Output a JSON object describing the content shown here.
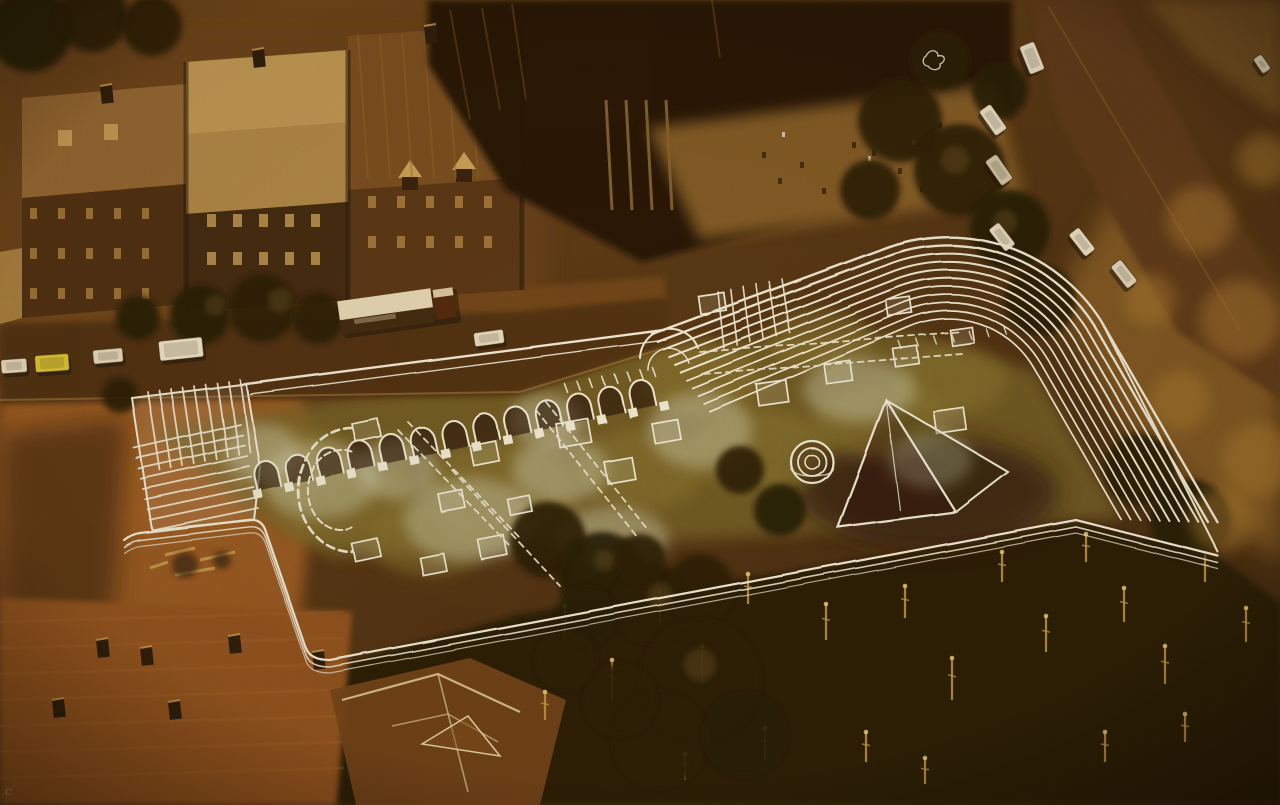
{
  "image": {
    "title": "Aerial photograph with architectural proposal overlay",
    "description": "Vintage amber-toned aerial photograph of a historic cathedral precinct. A white hand-drawn architectural proposal is superimposed on the photo: an L-shaped shelter with an arched arcade, a ribbed roof band sweeping around a large curved corner, a pyramid skylight, a small circular well and dashed outlines of excavated ruins in a garden court. Terraced rowhouses and a parked box lorry line the street at top left, cars park along a tree-lined street at upper right, a rust-orange plaza opens at left, and dark gothic pinnacled roofs fill the bottom of the frame.",
    "style": "1970s halftone colour print, heavy sepia-amber cast, coarse grain",
    "width_px": 1280,
    "height_px": 805
  },
  "palette": {
    "deep_shadow": "#231405",
    "mid_brown": "#5f3b15",
    "golden_tan": "#b9873b",
    "highlight_gold": "#e2c587",
    "plaza_orange": "#965722",
    "street_brown": "#47290e",
    "overlay_ink": "#f1efe0",
    "cool_ink": "#dde6e2",
    "pale_excavation": "#d5dbc6",
    "moss_green": "#7d6e2c",
    "taxi_yellow": "#ddc632",
    "car_white": "#e9dfc6",
    "pinnacle_gold": "#c79a44"
  },
  "scene": {
    "marginal_mark": "c",
    "overlay": {
      "label": "proposed shelter drawing",
      "ink": "#f1efe0",
      "arch_count": 13,
      "rib_count": 11,
      "fan_nw_count": 9,
      "fan_west_count": 9,
      "fan_patch_count": 6,
      "features": [
        "arched arcade",
        "ribbed roof band",
        "curved corner",
        "pyramid skylight",
        "concentric circular well",
        "dashed excavated wall footprints",
        "triple boundary lines"
      ]
    },
    "vehicles": [
      {
        "kind": "car",
        "label": "parked car",
        "color": "#e9dfc6",
        "x": 14,
        "y": 366,
        "len": 26,
        "wid": 14,
        "angle": -4
      },
      {
        "kind": "car",
        "label": "yellow car",
        "color": "#ddc632",
        "x": 52,
        "y": 363,
        "len": 34,
        "wid": 17,
        "angle": -4
      },
      {
        "kind": "car",
        "label": "parked car",
        "color": "#e6dcc2",
        "x": 108,
        "y": 356,
        "len": 30,
        "wid": 14,
        "angle": -5
      },
      {
        "kind": "van",
        "label": "white van",
        "color": "#f0e8d2",
        "x": 181,
        "y": 349,
        "len": 44,
        "wid": 20,
        "angle": -6
      },
      {
        "kind": "truck",
        "label": "box lorry",
        "color": "#e6dabc",
        "x": 398,
        "y": 310,
        "len": 118,
        "wid": 34,
        "angle": -8
      },
      {
        "kind": "car",
        "label": "parked car",
        "color": "#e8dec6",
        "x": 489,
        "y": 338,
        "len": 30,
        "wid": 14,
        "angle": -8
      },
      {
        "kind": "van",
        "label": "white van",
        "color": "#e8e0cc",
        "x": 1032,
        "y": 58,
        "len": 30,
        "wid": 16,
        "angle": 68
      },
      {
        "kind": "car",
        "label": "parked car",
        "color": "#eae2cc",
        "x": 993,
        "y": 120,
        "len": 30,
        "wid": 14,
        "angle": 55
      },
      {
        "kind": "car",
        "label": "parked car",
        "color": "#cdc4aa",
        "x": 999,
        "y": 170,
        "len": 30,
        "wid": 14,
        "angle": 55
      },
      {
        "kind": "car",
        "label": "parked car",
        "color": "#e7dfc8",
        "x": 1002,
        "y": 237,
        "len": 28,
        "wid": 13,
        "angle": 52
      },
      {
        "kind": "car",
        "label": "parked car",
        "color": "#ece4ce",
        "x": 1082,
        "y": 242,
        "len": 28,
        "wid": 13,
        "angle": 52
      },
      {
        "kind": "car",
        "label": "parked car",
        "color": "#e4dac2",
        "x": 1124,
        "y": 274,
        "len": 28,
        "wid": 13,
        "angle": 52
      },
      {
        "kind": "car",
        "label": "parked car",
        "color": "#e0d8c0",
        "x": 1262,
        "y": 64,
        "len": 18,
        "wid": 10,
        "angle": 55
      }
    ]
  }
}
